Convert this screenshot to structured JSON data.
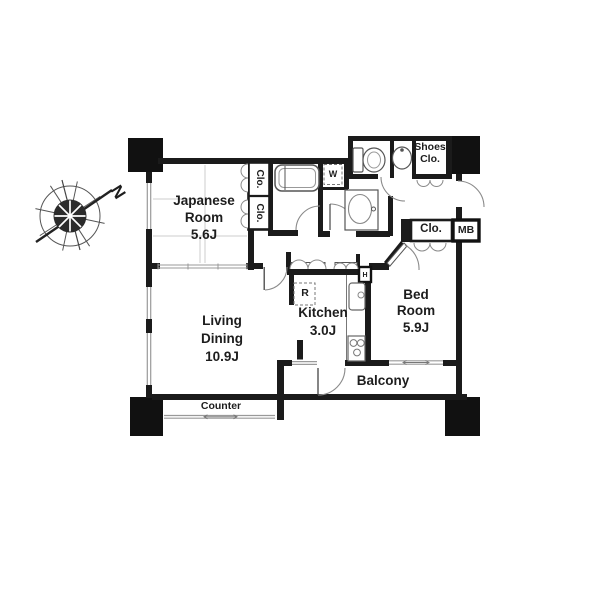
{
  "compass": {
    "north_label": "N"
  },
  "rooms": {
    "japanese_room": {
      "name_line1": "Japanese",
      "name_line2": "Room",
      "size": "5.6J"
    },
    "living_dining": {
      "name_line1": "Living",
      "name_line2": "Dining",
      "size": "10.9J"
    },
    "kitchen": {
      "name": "Kitchen",
      "size": "3.0J"
    },
    "bed_room": {
      "name_line1": "Bed",
      "name_line2": "Room",
      "size": "5.9J"
    },
    "balcony": {
      "name": "Balcony"
    },
    "counter": {
      "name": "Counter"
    }
  },
  "storage": {
    "japanese_closet_upper": "Clo.",
    "japanese_closet_lower": "Clo.",
    "shoes_closet_line1": "Shoes",
    "shoes_closet_line2": "Clo.",
    "bedroom_closet": "Clo.",
    "meter_box": "MB"
  },
  "appliances": {
    "washer_space": "W",
    "refrigerator_space": "R",
    "hatch": "H"
  },
  "colors": {
    "wall": "#1b1b1b",
    "column_fill": "#111111",
    "window_glass": "#9a9a9a",
    "fixture_outline": "#666666",
    "tatami_line": "#cccccc"
  }
}
